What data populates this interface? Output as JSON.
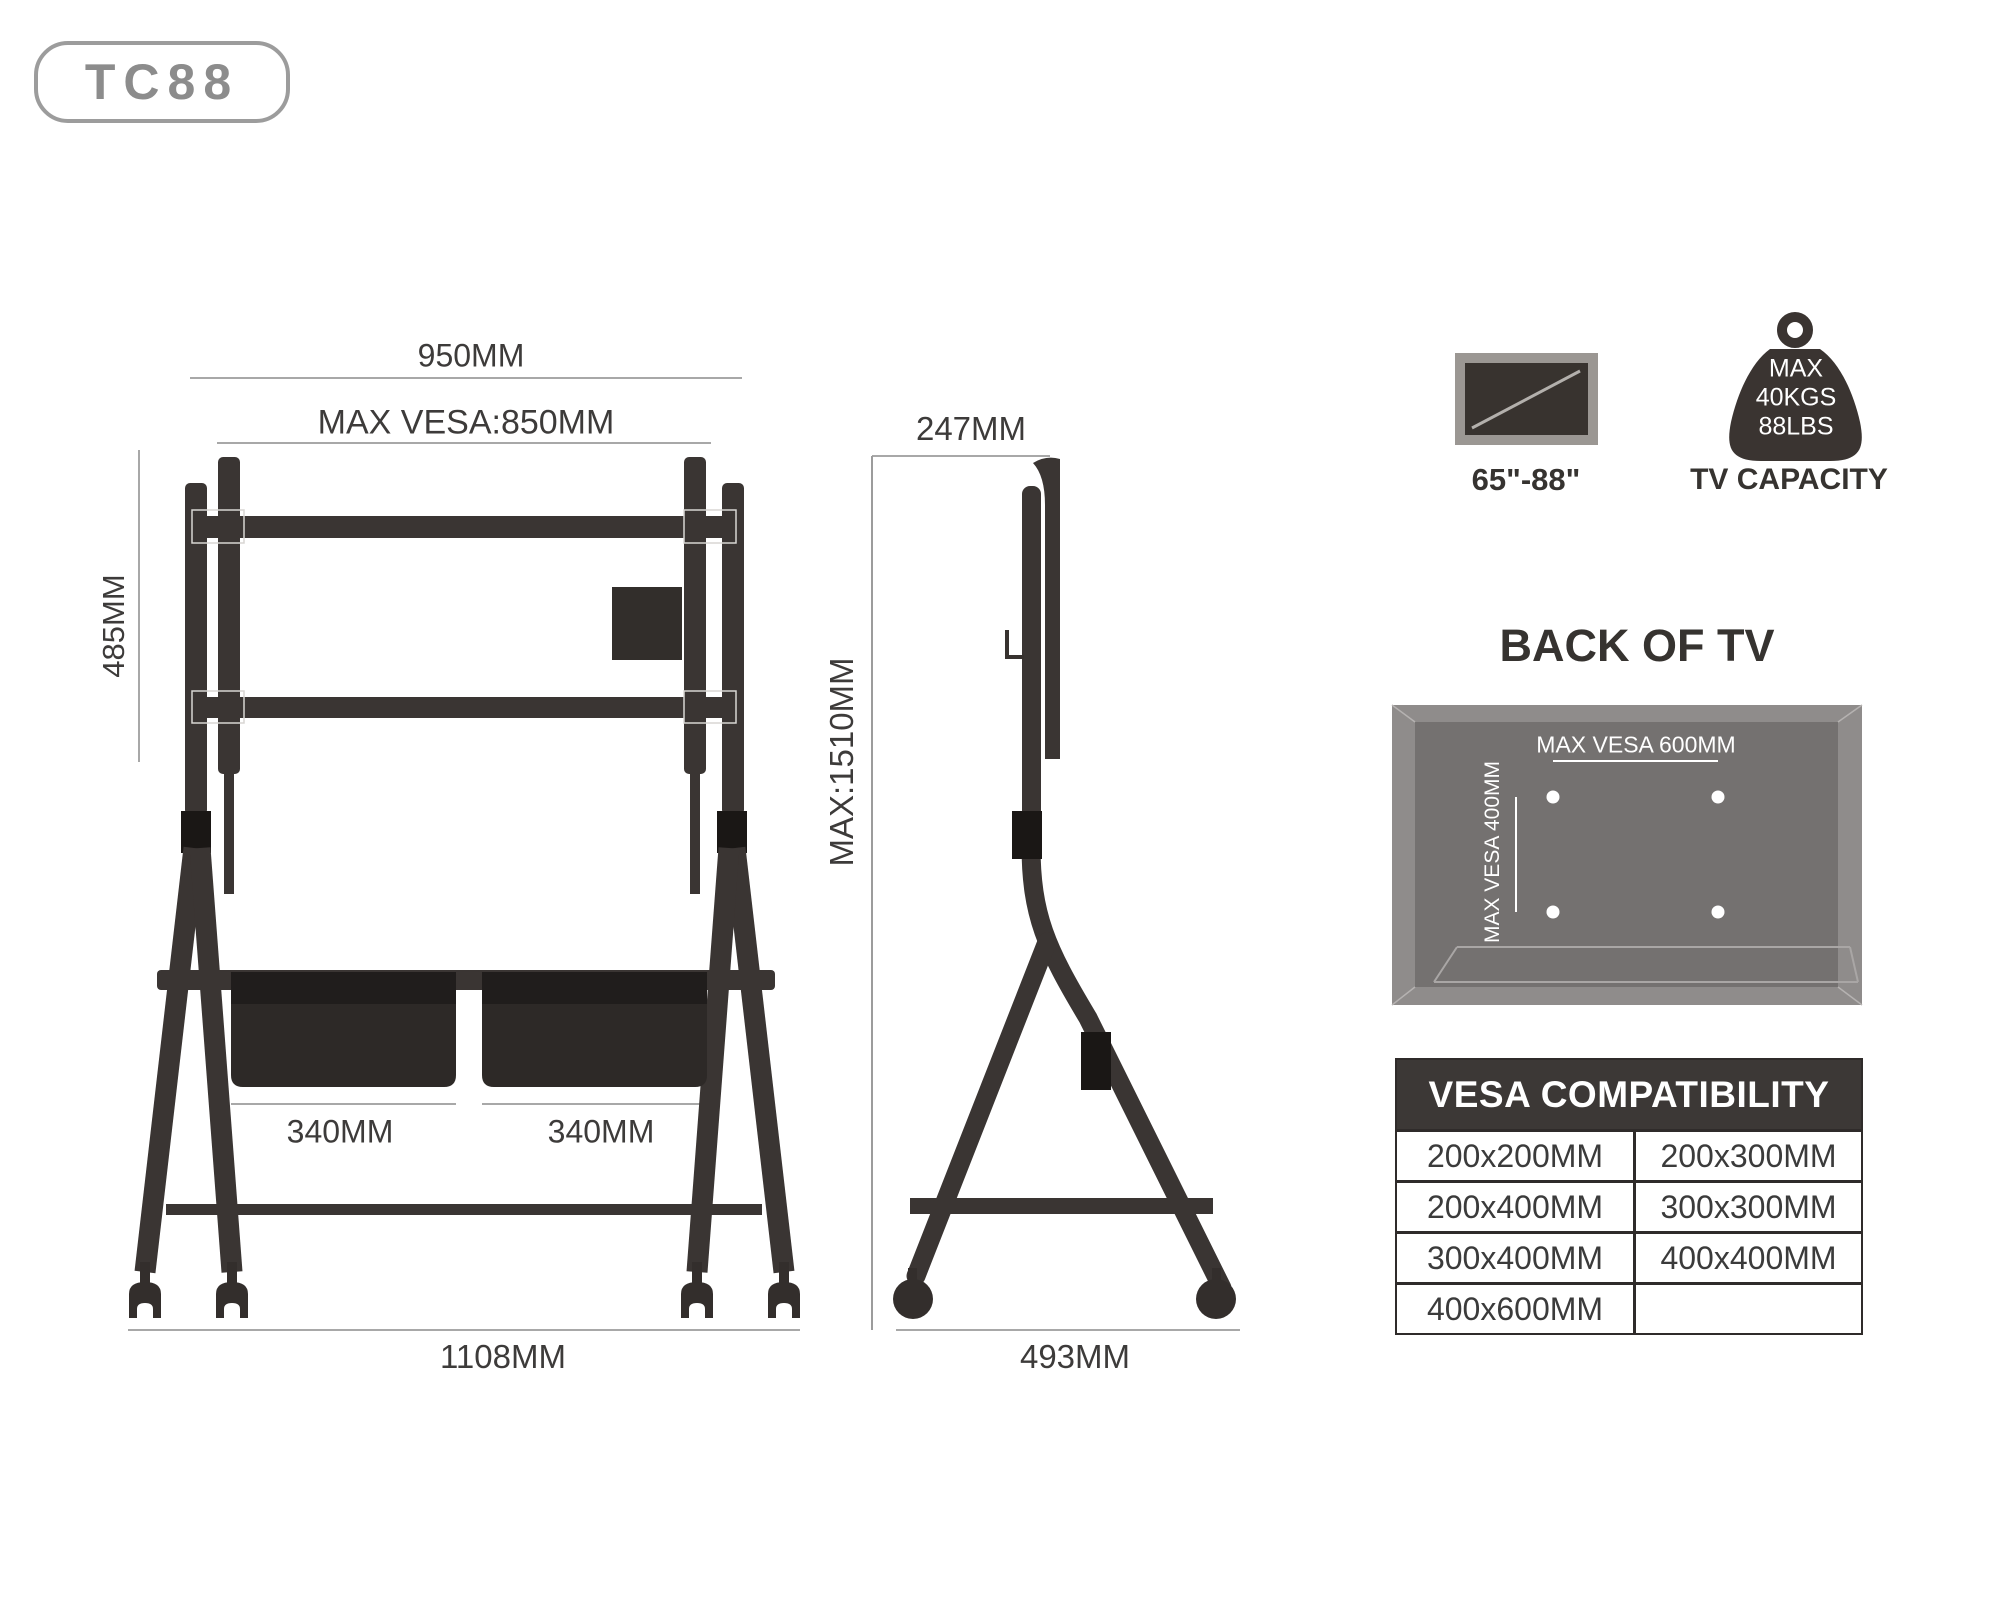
{
  "badge": {
    "label": "TC88"
  },
  "colors": {
    "structure": "#3a3533",
    "clamp_black": "#1a1715",
    "basket_band": "#201d1c",
    "basket_body": "#2d2927",
    "media_box": "#322e2b",
    "dim_line": "#a8a8a8",
    "dim_text": "#3d3b3a",
    "heading_text": "#363330",
    "badge_gray": "#8c8c8c",
    "panel_outer": "#8f8c8b",
    "panel_inner": "#747170",
    "table_header_bg": "#3c3836",
    "table_border": "#2f2b2a",
    "white": "#ffffff"
  },
  "front_view": {
    "dim_width_top": "950MM",
    "dim_max_vesa": "MAX VESA:850MM",
    "dim_height_left": "485MM",
    "dim_basket_left": "340MM",
    "dim_basket_right": "340MM",
    "dim_width_bottom": "1108MM"
  },
  "side_view": {
    "dim_depth_top": "247MM",
    "dim_max_height": "MAX:1510MM",
    "dim_depth_bottom": "493MM"
  },
  "icons": {
    "tv_size_label": "65\"-88\"",
    "capacity_line1": "MAX",
    "capacity_line2": "40KGS",
    "capacity_line3": "88LBS",
    "capacity_label": "TV CAPACITY"
  },
  "back_of_tv": {
    "title": "BACK OF TV",
    "max_vesa_horizontal": "MAX VESA 600MM",
    "max_vesa_vertical": "MAX VESA 400MM"
  },
  "vesa_table": {
    "title": "VESA COMPATIBILITY",
    "rows": [
      [
        "200x200MM",
        "200x300MM"
      ],
      [
        "200x400MM",
        "300x300MM"
      ],
      [
        "300x400MM",
        "400x400MM"
      ],
      [
        "400x600MM",
        ""
      ]
    ]
  }
}
